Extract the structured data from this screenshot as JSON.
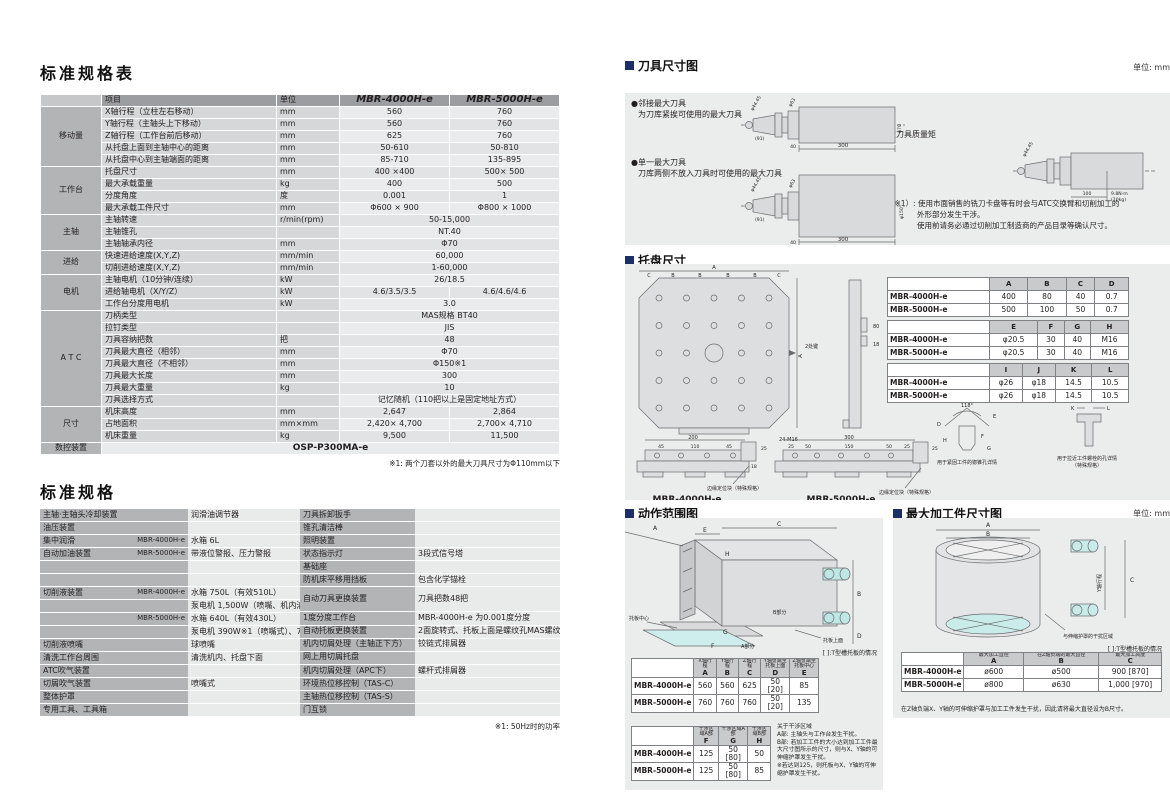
{
  "spec_table": {
    "title": "标准规格表",
    "col_item": "项目",
    "col_unit": "单位",
    "model1": "MBR-4000H-e",
    "model2": "MBR-5000H-e",
    "rows": [
      {
        "g": "移动量",
        "gs": 5,
        "item": "X轴行程（立柱左右移动）",
        "unit": "mm",
        "v1": "560",
        "v2": "760"
      },
      {
        "item": "Y轴行程（主轴头上下移动）",
        "unit": "mm",
        "v1": "560",
        "v2": "760"
      },
      {
        "item": "Z轴行程（工作台前后移动）",
        "unit": "mm",
        "v1": "625",
        "v2": "760"
      },
      {
        "item": "从托盘上面到主轴中心的距离",
        "unit": "mm",
        "v1": "50-610",
        "v2": "50-810"
      },
      {
        "item": "从托盘中心到主轴端面的距离",
        "unit": "mm",
        "v1": "85-710",
        "v2": "135-895"
      },
      {
        "g": "工作台",
        "gs": 4,
        "item": "托盘尺寸",
        "unit": "mm",
        "v1": "400 ×400",
        "v2": "500× 500"
      },
      {
        "item": "最大承载重量",
        "unit": "kg",
        "v1": "400",
        "v2": "500"
      },
      {
        "item": "分度角度",
        "unit": "度",
        "v1": "0.001",
        "v2": "1"
      },
      {
        "item": "最大承载工件尺寸",
        "unit": "mm",
        "v1": "Φ600 × 900",
        "v2": "Φ800 × 1000"
      },
      {
        "g": "主轴",
        "gs": 3,
        "item": "主轴转速",
        "unit": "r/min(rpm)",
        "span": "50-15,000"
      },
      {
        "item": "主轴锥孔",
        "unit": "",
        "span": "NT.40"
      },
      {
        "item": "主轴轴承内径",
        "unit": "mm",
        "span": "Φ70"
      },
      {
        "g": "进给",
        "gs": 2,
        "item": "快速进给速度(X,Y,Z)",
        "unit": "mm/min",
        "span": "60,000"
      },
      {
        "item": "切削进给速度(X,Y,Z)",
        "unit": "mm/min",
        "span": "1-60,000"
      },
      {
        "g": "电机",
        "gs": 3,
        "item": "主轴电机（10分钟/连续）",
        "unit": "kW",
        "span": "26/18.5"
      },
      {
        "item": "进给轴电机（X/Y/Z）",
        "unit": "kW",
        "v1": "4.6/3.5/3.5",
        "v2": "4.6/4.6/4.6"
      },
      {
        "item": "工作台分度用电机",
        "unit": "kW",
        "span": "3.0"
      },
      {
        "g": "A T C",
        "gs": 8,
        "item": "刀柄类型",
        "unit": "",
        "span": "MAS规格 BT40"
      },
      {
        "item": "拉钉类型",
        "unit": "",
        "span": "JIS"
      },
      {
        "item": "刀具容纳把数",
        "unit": "把",
        "span": "48"
      },
      {
        "item": "刀具最大直径（相邻）",
        "unit": "mm",
        "span": "Φ70"
      },
      {
        "item": "刀具最大直径（不相邻）",
        "unit": "mm",
        "span": "Φ150※1"
      },
      {
        "item": "刀具最大长度",
        "unit": "mm",
        "span": "300"
      },
      {
        "item": "刀具最大重量",
        "unit": "kg",
        "span": "10"
      },
      {
        "item": "刀具选择方式",
        "unit": "",
        "span": "记忆随机（110把以上是固定地址方式）"
      },
      {
        "g": "尺寸",
        "gs": 3,
        "item": "机床高度",
        "unit": "mm",
        "v1": "2,647",
        "v2": "2,864"
      },
      {
        "item": "占地面积",
        "unit": "mm×mm",
        "v1": "2,420× 4,700",
        "v2": "2,700× 4,710"
      },
      {
        "item": "机床重量",
        "unit": "kg",
        "v1": "9,500",
        "v2": "11,500"
      },
      {
        "g": "数控装置",
        "gs": 1,
        "nc": true,
        "span": "OSP-P300MA-e"
      }
    ],
    "note": "※1: 两个刀套以外的最大刀具尺寸为Φ110mm以下"
  },
  "equip_table": {
    "title": "标准规格",
    "left": [
      {
        "l": "主轴·主轴头冷却装置",
        "s": "",
        "v": "润滑油调节器"
      },
      {
        "l": "油压装置",
        "s": "",
        "v": ""
      },
      {
        "l": "集中润滑",
        "s": "MBR-4000H-e",
        "v": "水箱 6L"
      },
      {
        "l": "自动加油装置",
        "s": "MBR-5000H-e",
        "v": "带液位警报、压力警报"
      },
      {
        "l": "",
        "s": "",
        "v": ""
      },
      {
        "l": "",
        "s": "",
        "v": ""
      },
      {
        "l": "切削液装置",
        "s": "MBR-4000H-e",
        "v": "水箱 750L（有效510L）"
      },
      {
        "l": "",
        "s": "",
        "v": "泵电机 1,500W（喷嘴、机内清洗兼用）"
      },
      {
        "l": "",
        "s": "MBR-5000H-e",
        "v": "水箱 640L（有效430L）"
      },
      {
        "l": "",
        "s": "",
        "v": "泵电机 390W※1（喷嘴式）、730W※1（机内清洗用）"
      },
      {
        "l": "切削液喷嘴",
        "s": "",
        "v": "球喷嘴"
      },
      {
        "l": "清洗工作台周围",
        "s": "",
        "v": "清洗机内、托盘下面"
      },
      {
        "l": "ATC吹气装置",
        "s": "",
        "v": ""
      },
      {
        "l": "切屑吹气装置",
        "s": "",
        "v": "喷嘴式"
      },
      {
        "l": "整体护罩",
        "s": "",
        "v": ""
      },
      {
        "l": "专用工具、工具箱",
        "s": "",
        "v": ""
      }
    ],
    "right": [
      {
        "l": "刀具拆卸扳手",
        "v": ""
      },
      {
        "l": "锥孔清洁棒",
        "v": ""
      },
      {
        "l": "照明装置",
        "v": ""
      },
      {
        "l": "状态指示灯",
        "v": "3段式信号塔"
      },
      {
        "l": "基础座",
        "v": ""
      },
      {
        "l": "防机床平移用挡板",
        "v": "包含化学锚栓"
      },
      {
        "l": "自动刀具更换装置",
        "v": "刀具把数48把",
        "h": 2
      },
      {
        "l": "1度分度工作台",
        "v": "MBR-4000H-e 为0.001度分度"
      },
      {
        "l": "自动托板更换装置",
        "v": "2面旋转式、托板上面是螺纹孔MAS螺纹型"
      },
      {
        "l": "机内切屑处理（主轴正下方）",
        "v": "铰链式排屑器"
      },
      {
        "l": "网上用切屑托盘",
        "v": ""
      },
      {
        "l": "机内切屑处理（APC下）",
        "v": "螺杆式排屑器"
      },
      {
        "l": "环境热位移控制（TAS-C）",
        "v": ""
      },
      {
        "l": "主轴热位移控制（TAS-S）",
        "v": ""
      },
      {
        "l": "门互锁",
        "v": ""
      }
    ],
    "note": "※1: 50Hz时的功率"
  },
  "tool_section": {
    "title": "刀具尺寸图",
    "unit": "单位: mm",
    "b1": "●邻接最大刀具",
    "b1sub": "为刀库紧挨可使用的最大刀具",
    "b2": "●单一最大刀具",
    "b2sub": "刀库两侧不放入刀具时可使用的最大刀具",
    "b3": "●最大刀具质量矩",
    "note1": "（※1）: 使用市面销售的铣刀卡盘等有时会与ATC交换臂和切削加工的",
    "note2": "外形部分发生干涉。",
    "note3": "使用前请务必通过切削加工制造商的产品目录等确认尺寸。",
    "dims": {
      "phi4445": "φ44.45",
      "phi63": "φ63",
      "phi70": "φ70",
      "phi150": "φ150",
      "taper": "(91)",
      "d40": "40",
      "d300": "300",
      "d100": "100",
      "torque": "9.8N·m",
      "torque_kg": "(10kg)"
    }
  },
  "pallet_section": {
    "title": "托盘尺寸",
    "tables": [
      {
        "cols": [
          {
            "k": "A"
          },
          {
            "k": "B"
          },
          {
            "k": "C"
          },
          {
            "k": "D"
          }
        ],
        "rows": [
          [
            "MBR-4000H-e",
            "400",
            "80",
            "40",
            "0.7"
          ],
          [
            "MBR-5000H-e",
            "500",
            "100",
            "50",
            "0.7"
          ]
        ]
      },
      {
        "cols": [
          {
            "k": "E"
          },
          {
            "k": "F"
          },
          {
            "k": "G"
          },
          {
            "k": "H"
          }
        ],
        "rows": [
          [
            "MBR-4000H-e",
            "φ20.5",
            "30",
            "40",
            "M16"
          ],
          [
            "MBR-5000H-e",
            "φ20.5",
            "30",
            "40",
            "M16"
          ]
        ]
      },
      {
        "cols": [
          {
            "k": "I"
          },
          {
            "k": "J"
          },
          {
            "k": "K"
          },
          {
            "k": "L"
          }
        ],
        "rows": [
          [
            "MBR-4000H-e",
            "φ26",
            "φ18",
            "14.5",
            "10.5"
          ],
          [
            "MBR-5000H-e",
            "φ26",
            "φ18",
            "14.5",
            "10.5"
          ]
        ]
      }
    ],
    "d": {
      "A": "A",
      "tickB": "B",
      "tickC": "C",
      "keys": "2处键",
      "m16": "24-M16",
      "deg": "118°",
      "D": "D",
      "E": "E",
      "F": "F",
      "G": "G",
      "H": "H",
      "K": "K",
      "L": "L",
      "v200": "200",
      "v45": "45",
      "v110": "110",
      "v25": "25",
      "v18": "18",
      "v300": "300",
      "v50": "50",
      "v150": "150",
      "v80": "80"
    },
    "edge_note": "边缘定位块（特殊规格）",
    "cap1": "用于紧固工件的锪锥孔详情",
    "cap2a": "用于拉近工件螺栓的孔详情",
    "cap2b": "（特殊规格）",
    "m1": "MBR-4000H-e",
    "m2": "MBR-5000H-e"
  },
  "motion_section": {
    "title": "动作范围图",
    "bracket_note": "[ ]:T型槽托板的情况",
    "t1_cols": [
      {
        "t": "X轴行程",
        "k": "A"
      },
      {
        "t": "Y轴行程",
        "k": "B"
      },
      {
        "t": "Z轴行程",
        "k": "C"
      },
      {
        "t": "Y轴负端至托板上面",
        "k": "D"
      },
      {
        "t": "Z轴负端至托板中心",
        "k": "E"
      }
    ],
    "t1_rows": [
      [
        "MBR-4000H-e",
        "560",
        "560",
        "625",
        "50 [20]",
        "85"
      ],
      [
        "MBR-5000H-e",
        "760",
        "760",
        "760",
        "50 [20]",
        "135"
      ]
    ],
    "t2_cols": [
      {
        "t": "干涉区域A部",
        "k": "F"
      },
      {
        "t": "干涉区域A部",
        "k": "G"
      },
      {
        "t": "干涉区域B部",
        "k": "H"
      }
    ],
    "t2_rows": [
      [
        "MBR-4000H-e",
        "125",
        "50 [80]",
        "50"
      ],
      [
        "MBR-5000H-e",
        "125",
        "50 [80]",
        "85"
      ]
    ],
    "note_lines": [
      "关于干涉区域",
      "A部: 主轴头与工作台发生干扰。",
      "B部: 若加工工件的大小达到加工工件最大尺寸图所示的尺寸，则与X、Y轴的可伸缩护罩发生干扰。",
      "※若达到125，则托板与X、Y轴的可伸缩护罩发生干扰。"
    ],
    "d": {
      "A": "A",
      "B": "B",
      "C": "C",
      "D": "D",
      "E": "E",
      "F": "F",
      "G": "G",
      "H": "H",
      "center": "托板中心",
      "top": "托板上面",
      "ap": "A部分",
      "bp": "B部分"
    }
  },
  "workpiece_section": {
    "title": "最大加工件尺寸图",
    "unit": "单位: mm",
    "bracket_note": "[ ]:T型槽托板的情况",
    "cols": [
      {
        "t": "最大加工直径",
        "k": "A"
      },
      {
        "t": "在Z轴负端的最大直径",
        "k": "B"
      },
      {
        "t": "最大加工高度",
        "k": "C"
      }
    ],
    "rows": [
      [
        "MBR-4000H-e",
        "ø600",
        "ø500",
        "900 [870]"
      ],
      [
        "MBR-5000H-e",
        "ø800",
        "ø630",
        "1,000 [970]"
      ]
    ],
    "footnote": "在Z轴负端X、Y轴的可伸缩护罩与加工工件发生干扰，因此请将最大直径设为B尺寸。",
    "d": {
      "A": "A",
      "B": "B",
      "C": "C",
      "ytravel": "Y轴行程",
      "interf": "与伸缩护罩的干扰区域"
    }
  }
}
